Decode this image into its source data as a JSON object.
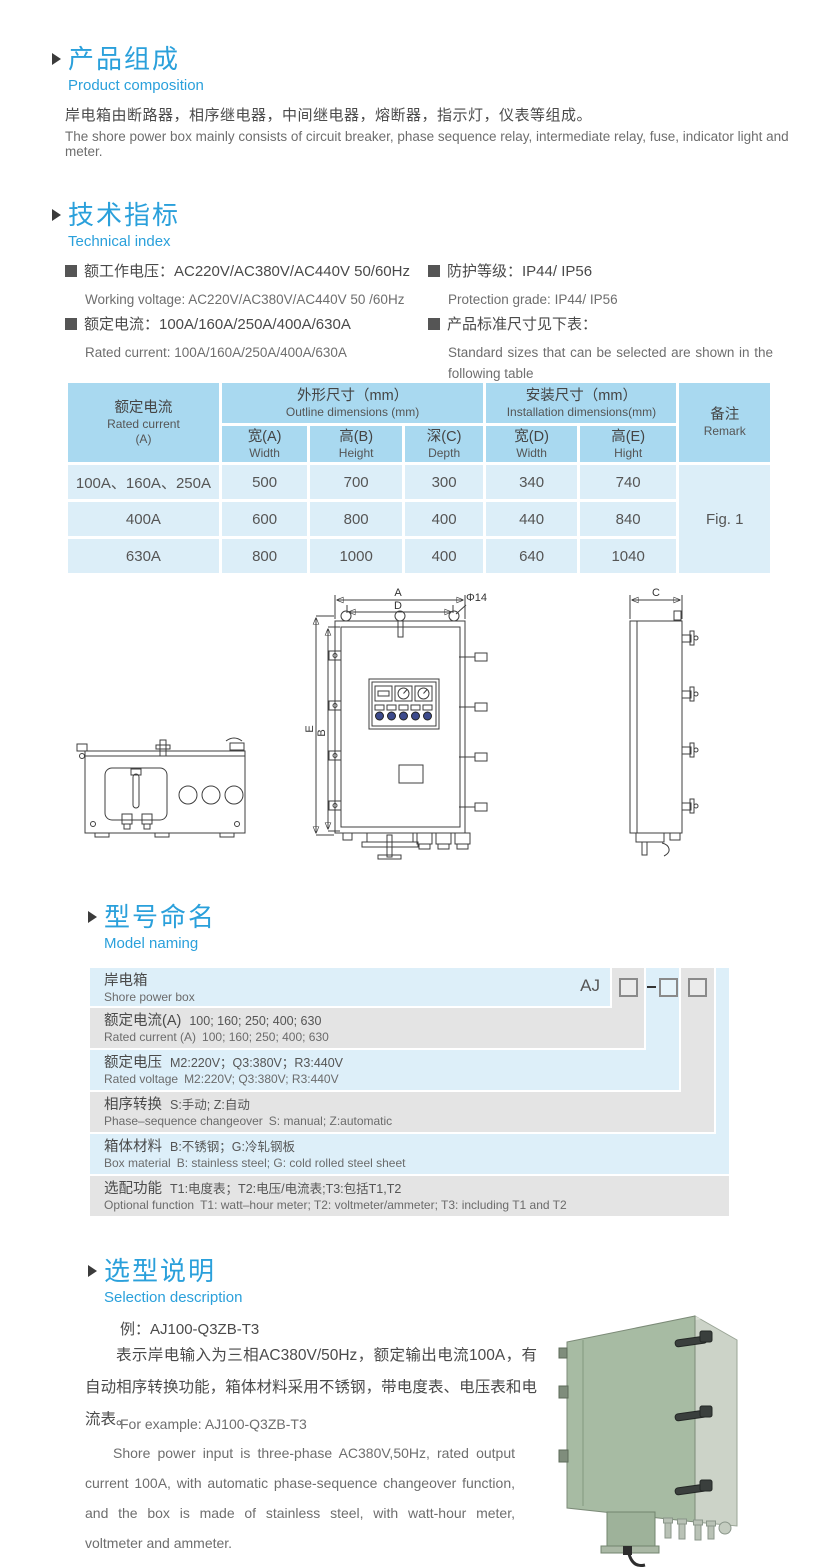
{
  "colors": {
    "accent_blue": "#2aa0db",
    "table_header_bg": "#a9d9f0",
    "table_cell_bg": "#dceef8",
    "naming_row_blue": "#ddeff9",
    "naming_row_gray": "#e4e4e4",
    "box_front_green": "#a7bba3",
    "box_side_green": "#ccd3c8"
  },
  "section_product": {
    "title_zh": "产品组成",
    "title_en": "Product  composition",
    "para_zh": "岸电箱由断路器，相序继电器，中间继电器，熔断器，指示灯，仪表等组成。",
    "para_en": "The shore power box mainly consists of circuit breaker, phase sequence relay, intermediate relay, fuse, indicator light and meter."
  },
  "section_tech": {
    "title_zh": "技术指标",
    "title_en": "Technical index",
    "spec_voltage_zh": "额工作电压：AC220V/AC380V/AC440V  50/60Hz",
    "spec_voltage_en": "Working voltage: AC220V/AC380V/AC440V 50 /60Hz",
    "spec_current_zh": "额定电流：100A/160A/250A/400A/630A",
    "spec_current_en": "Rated current: 100A/160A/250A/400A/630A",
    "spec_protection_zh": "防护等级：IP44/ IP56",
    "spec_protection_en": "Protection grade: IP44/ IP56",
    "spec_sizes_zh": "产品标准尺寸见下表：",
    "spec_sizes_en": "Standard sizes that can be selected are shown in the following table"
  },
  "dim_table": {
    "rated_current_zh": "额定电流",
    "rated_current_en": "Rated current",
    "rated_current_unit": "(A)",
    "outline_zh": "外形尺寸（mm）",
    "outline_en": "Outline dimensions (mm)",
    "install_zh": "安装尺寸（mm）",
    "install_en": "Installation dimensions(mm)",
    "remark_zh": "备注",
    "remark_en": "Remark",
    "sub_headers": [
      {
        "zh": "宽(A)",
        "en": "Width"
      },
      {
        "zh": "高(B)",
        "en": "Height"
      },
      {
        "zh": "深(C)",
        "en": "Depth"
      },
      {
        "zh": "宽(D)",
        "en": "Width"
      },
      {
        "zh": "高(E)",
        "en": "Hight"
      }
    ],
    "rows": [
      [
        "100A、160A、250A",
        "500",
        "700",
        "300",
        "340",
        "740"
      ],
      [
        "400A",
        "600",
        "800",
        "400",
        "440",
        "840"
      ],
      [
        "630A",
        "800",
        "1000",
        "400",
        "640",
        "1040"
      ]
    ],
    "remark_value": "Fig. 1"
  },
  "drawing": {
    "dim_a": "A",
    "dim_b": "B",
    "dim_c": "C",
    "dim_d": "D",
    "dim_e": "E",
    "hole_label": "Φ14"
  },
  "section_model": {
    "title_zh": "型号命名",
    "title_en": "Model naming",
    "prefix": "AJ",
    "rows": [
      {
        "label_zh": "岸电箱",
        "codes_zh": "",
        "label_en": "Shore power box",
        "codes_en": ""
      },
      {
        "label_zh": "额定电流(A)",
        "codes_zh": "100; 160; 250; 400; 630",
        "label_en": "Rated current (A)",
        "codes_en": "100; 160; 250; 400; 630"
      },
      {
        "label_zh": "额定电压",
        "codes_zh": "M2:220V；Q3:380V；R3:440V",
        "label_en": "Rated voltage",
        "codes_en": "M2:220V;  Q3:380V;  R3:440V"
      },
      {
        "label_zh": "相序转换",
        "codes_zh": "S:手动; Z:自动",
        "label_en": "Phase–sequence changeover",
        "codes_en": "S: manual;  Z:automatic"
      },
      {
        "label_zh": "箱体材料",
        "codes_zh": "B:不锈钢；G:冷轧钢板",
        "label_en": "Box material",
        "codes_en": "B: stainless steel; G: cold rolled steel sheet"
      },
      {
        "label_zh": "选配功能",
        "codes_zh": "T1:电度表；T2:电压/电流表;T3:包括T1,T2",
        "label_en": "Optional function",
        "codes_en": "T1: watt–hour meter; T2: voltmeter/ammeter; T3: including T1 and T2"
      }
    ]
  },
  "section_selection": {
    "title_zh": "选型说明",
    "title_en": "Selection description",
    "example_zh": "例：AJ100-Q3ZB-T3",
    "desc_zh": "表示岸电输入为三相AC380V/50Hz，额定输出电流100A，有自动相序转换功能，箱体材料采用不锈钢，带电度表、电压表和电流表。",
    "example_en": "For example: AJ100-Q3ZB-T3",
    "desc_en": "Shore power input is three-phase AC380V,50Hz, rated output current 100A, with automatic phase-sequence changeover function, and the box is made of stainless steel, with watt-hour meter, voltmeter and ammeter."
  }
}
